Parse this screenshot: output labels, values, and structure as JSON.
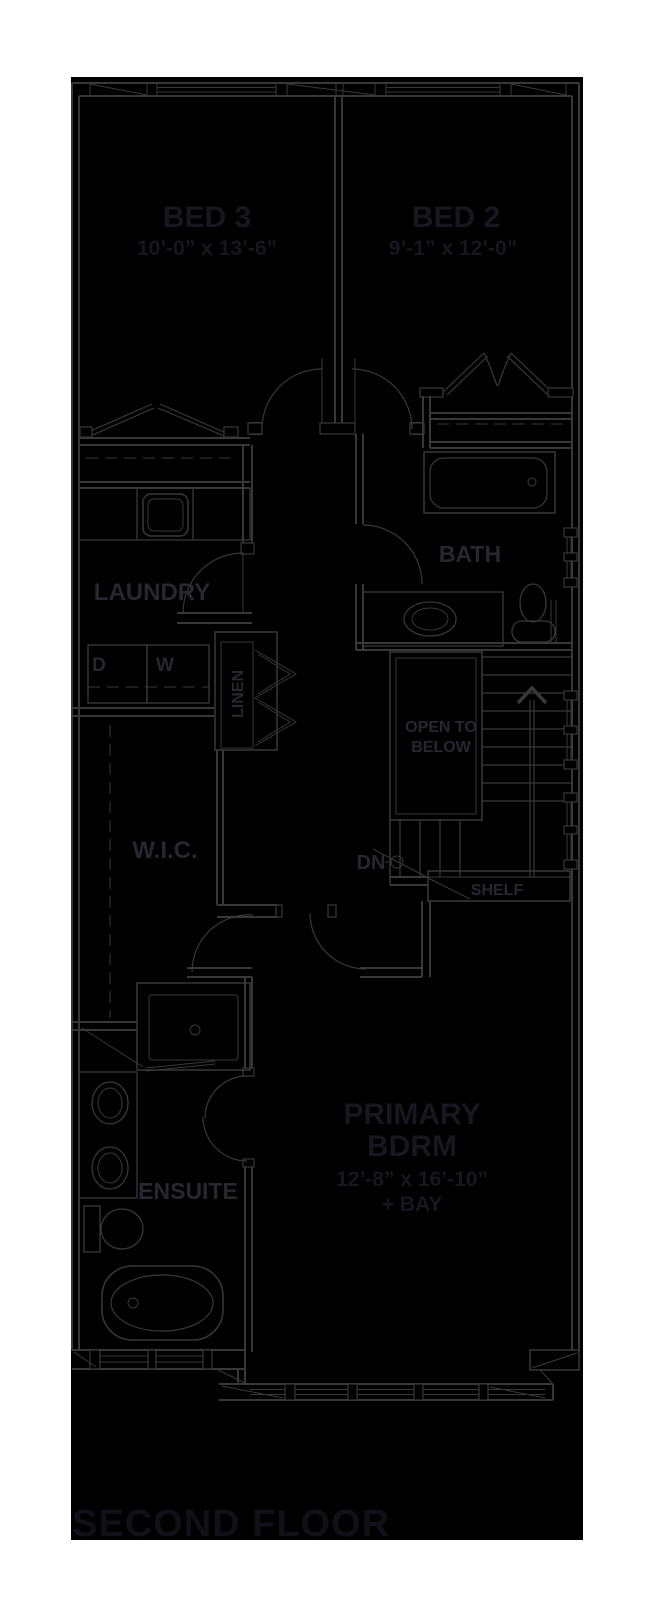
{
  "colors": {
    "page_background": "#ffffff",
    "plan_background": "#000000",
    "wall_line": "#3a3738",
    "room_label": "#26282d",
    "room_title": "#16181d",
    "floor_title": "#101116"
  },
  "floor": {
    "title": "SECOND FLOOR"
  },
  "rooms": {
    "bed3": {
      "label": "BED 3",
      "dims": "10’-0” x 13’-6”"
    },
    "bed2": {
      "label": "BED 2",
      "dims": "9’-1” x 12’-0”"
    },
    "laundry": {
      "label": "LAUNDRY"
    },
    "linen": {
      "label": "LINEN"
    },
    "bath": {
      "label": "BATH"
    },
    "wic": {
      "label": "W.I.C."
    },
    "ensuite": {
      "label": "ENSUITE"
    },
    "primary": {
      "label_line1": "PRIMARY",
      "label_line2": "BDRM",
      "dims": "12’-8” x 16’-10”",
      "dims2": "+ BAY"
    }
  },
  "annotations": {
    "open_below_line1": "OPEN TO",
    "open_below_line2": "BELOW",
    "down": "DN",
    "shelf": "SHELF",
    "dryer": "D",
    "washer": "W"
  }
}
